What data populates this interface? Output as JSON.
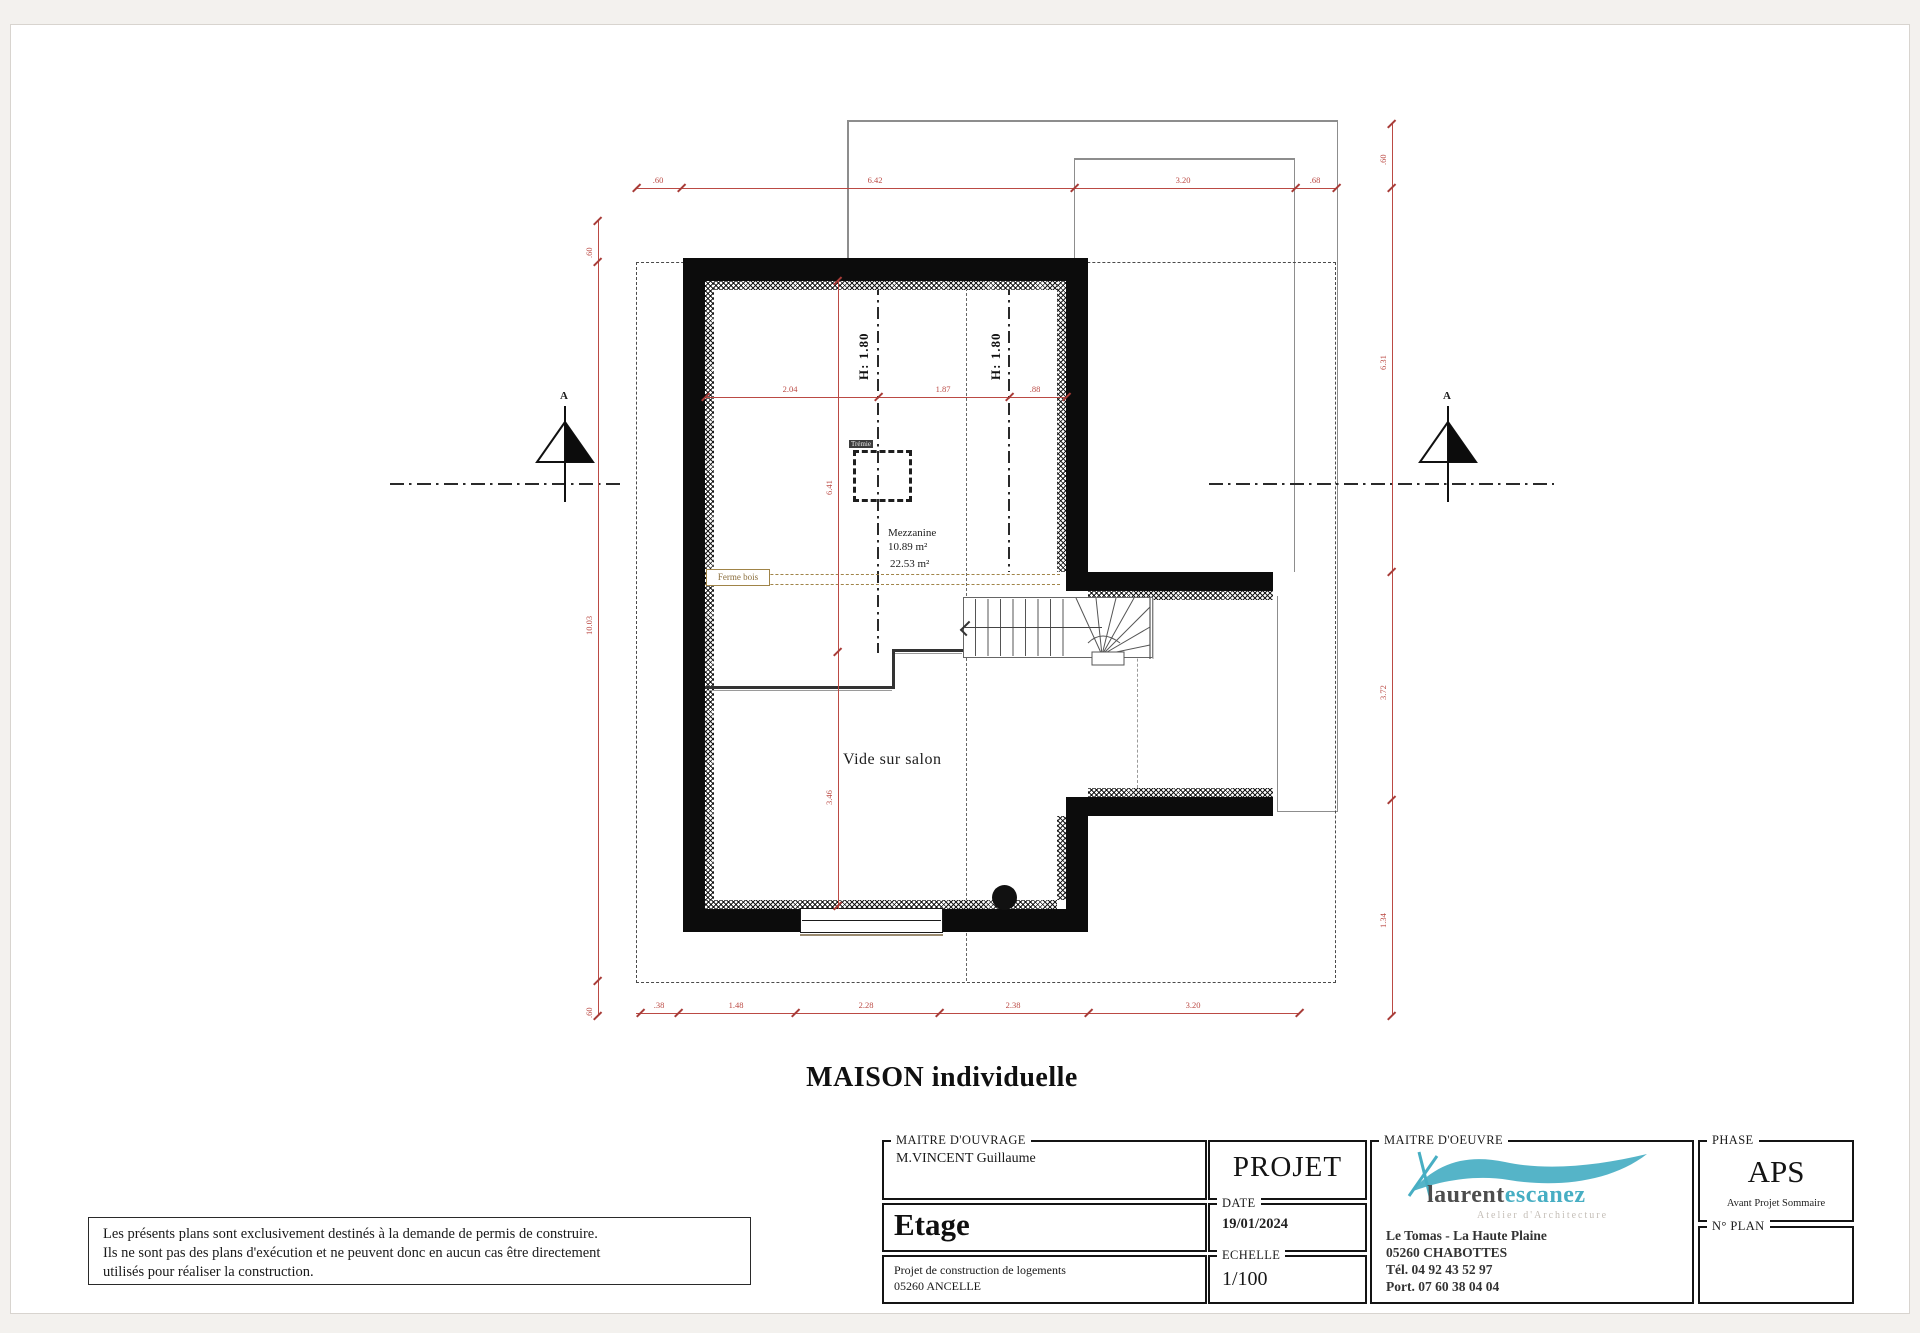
{
  "page": {
    "plan_title": "MAISON individuelle"
  },
  "plan": {
    "labels": {
      "vide_sur_salon": "Vide sur salon",
      "mezzanine": "Mezzanine",
      "mezzanine_area": "10.89 m²",
      "area_total": "22.53 m²",
      "ferme_bois": "Ferme bois",
      "tremie": "Trémie",
      "height_left": "H: 1.80",
      "height_right": "H: 1.80",
      "section_letter_left": "A",
      "section_letter_right": "A"
    },
    "dims": {
      "top": [
        ".60",
        "6.42",
        "3.20",
        ".68"
      ],
      "bottom": [
        ".38",
        "1.48",
        "2.28",
        "2.38",
        "3.20"
      ],
      "left": [
        ".60",
        "10.03",
        ".60"
      ],
      "right": [
        ".60",
        "6.31",
        "3.72",
        "1.34"
      ],
      "inner_h": [
        "2.04",
        "1.87",
        ".88"
      ],
      "inner_v": [
        "6.41",
        "3.46"
      ]
    }
  },
  "disclaimer": {
    "line1": "Les présents plans sont exclusivement destinés à la demande de permis de construire.",
    "line2": "Ils ne sont pas des plans d'exécution et ne peuvent donc en aucun cas être directement",
    "line3": "utilisés pour réaliser la construction."
  },
  "titleblock": {
    "maitre_ouvrage": {
      "label": "MAITRE D'OUVRAGE",
      "value": "M.VINCENT  Guillaume"
    },
    "drawing_name": "Etage",
    "project_desc": {
      "line1": "Projet de construction de logements",
      "line2": "05260 ANCELLE"
    },
    "projet": "PROJET",
    "date": {
      "label": "DATE",
      "value": "19/01/2024"
    },
    "echelle": {
      "label": "ECHELLE",
      "value": "1/100"
    },
    "maitre_oeuvre": {
      "label": "MAITRE D'OEUVRE",
      "logo_name1": "laurent",
      "logo_name2": "escanez",
      "logo_sub": "Atelier d'Architecture",
      "addr1": "Le Tomas - La Haute Plaine",
      "addr2": "05260 CHABOTTES",
      "addr3": "Tél. 04 92 43 52 97",
      "addr4": "Port. 07 60 38 04 04"
    },
    "phase": {
      "label": "PHASE",
      "value": "APS",
      "sub": "Avant Projet Sommaire"
    },
    "num_plan": {
      "label": "N° PLAN"
    }
  },
  "colors": {
    "dimension_red": "#bb4a44",
    "logo_teal": "#47aec3",
    "wall_black": "#0c0c0c",
    "ferme_bois_brown": "#8a6d3b"
  }
}
